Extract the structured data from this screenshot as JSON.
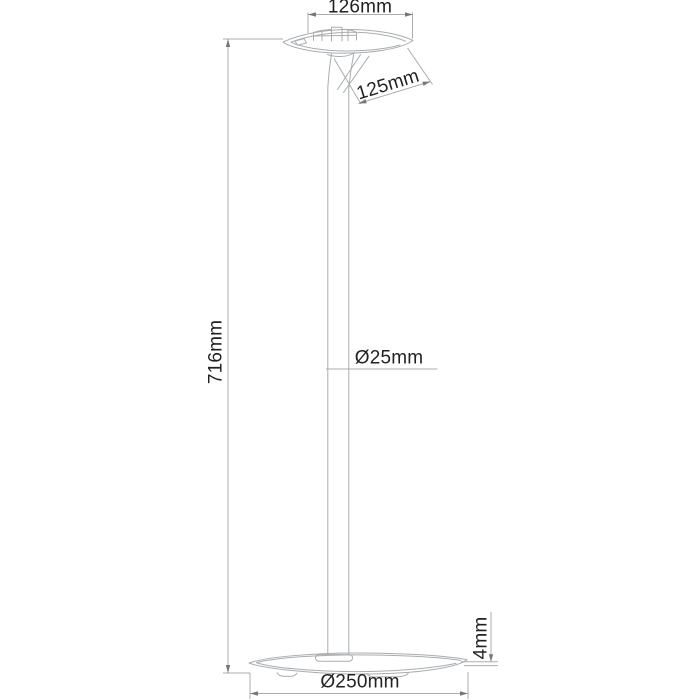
{
  "meta": {
    "background": "#ffffff",
    "line_color": "#a9adb0",
    "arrow_color": "#74787b",
    "text_color": "#222222",
    "unit": "mm"
  },
  "dimensions": {
    "top_width": {
      "label": "126mm"
    },
    "top_depth": {
      "label": "125mm"
    },
    "height": {
      "label": "716mm"
    },
    "pole_diameter": {
      "label": "Ø25mm"
    },
    "base_thickness": {
      "label": "4mm"
    },
    "base_diameter": {
      "label": "Ø250mm"
    }
  }
}
